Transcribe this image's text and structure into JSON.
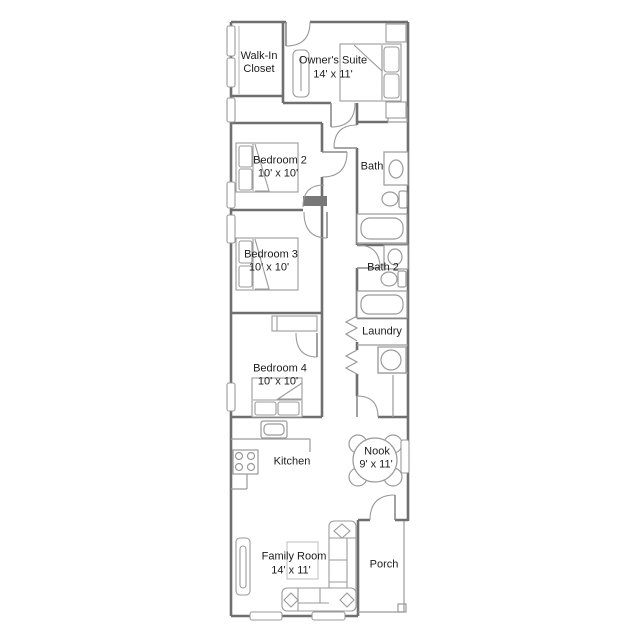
{
  "page": {
    "background": "#ffffff",
    "title": "floor-plan"
  },
  "plan": {
    "type": "single-wide floor plan",
    "wall_color": "#6f6f6f",
    "line_color": "#9a9a9a",
    "text_color": "#1c1c1c",
    "rooms": [
      {
        "id": "walk-in-closet",
        "label": "Walk-In Closet",
        "dims": ""
      },
      {
        "id": "owners-suite",
        "label": "Owner's Suite",
        "dims": "14' x 11'"
      },
      {
        "id": "bedroom-2",
        "label": "Bedroom 2",
        "dims": "10' x 10'"
      },
      {
        "id": "bath",
        "label": "Bath",
        "dims": ""
      },
      {
        "id": "bedroom-3",
        "label": "Bedroom 3",
        "dims": "10' x 10'"
      },
      {
        "id": "bath-2",
        "label": "Bath 2",
        "dims": ""
      },
      {
        "id": "laundry",
        "label": "Laundry",
        "dims": ""
      },
      {
        "id": "bedroom-4",
        "label": "Bedroom 4",
        "dims": "10' x 10'"
      },
      {
        "id": "kitchen",
        "label": "Kitchen",
        "dims": ""
      },
      {
        "id": "nook",
        "label": "Nook",
        "dims": "9' x 11'"
      },
      {
        "id": "family-room",
        "label": "Family Room",
        "dims": "14' x 11'"
      },
      {
        "id": "porch",
        "label": "Porch",
        "dims": ""
      }
    ],
    "fixtures": [
      "bed-icon",
      "pillow-icon",
      "nightstand-icon",
      "sliding-door-icon",
      "bathtub-icon",
      "toilet-icon",
      "sink-vanity-icon",
      "washer-icon",
      "range-icon",
      "kitchen-sink-icon",
      "dining-table-icon",
      "chair-icon",
      "sectional-sofa-icon",
      "tv-console-icon",
      "coffee-table-icon",
      "door-swing-icon",
      "bifold-door-icon",
      "window-icon",
      "porch-post-icon"
    ]
  }
}
